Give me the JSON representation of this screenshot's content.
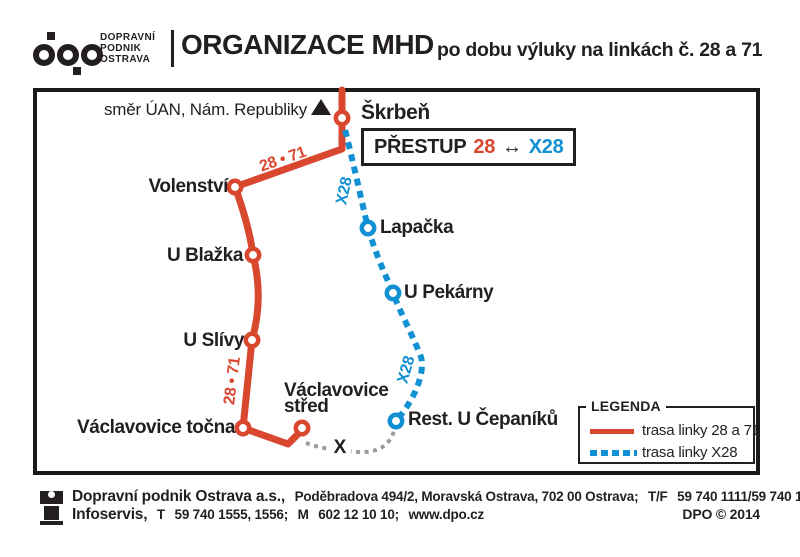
{
  "header": {
    "logo": {
      "line1": "DOPRAVNÍ",
      "line2": "PODNIK",
      "line3": "OSTRAVA"
    },
    "title": "ORGANIZACE MHD",
    "subtitle": "po dobu výluky na linkách č. 28 a 71"
  },
  "map": {
    "direction_note": "směr ÚAN, Nám. Republiky",
    "transfer": {
      "prefix": "PŘESTUP",
      "line_a": "28",
      "arrow": "↔",
      "line_b": "X28"
    },
    "route_labels": {
      "red_upper": "28 • 71",
      "red_lower": "28 • 71",
      "x28_upper": "X28",
      "x28_lower": "X28",
      "closure_mark": "X"
    },
    "stops": {
      "skrben": "Škrbeň",
      "volenstvi": "Volenství",
      "u_blazka": "U Blažka",
      "u_slivy": "U Slívy",
      "lapacka": "Lapačka",
      "u_pekarny": "U Pekárny",
      "vaclavovice_tocna": "Václavovice točna",
      "vaclavovice_stred_line1": "Václavovice",
      "vaclavovice_stred_line2": "střed",
      "rest_u_cepaniku": "Rest. U Čepaníků"
    },
    "colors": {
      "red": "#d9472f",
      "blue": "#1191d3",
      "gray": "#9b9b9b",
      "black": "#231f20"
    }
  },
  "legend": {
    "title": "LEGENDA",
    "items": [
      {
        "label": "trasa linky 28 a 71"
      },
      {
        "label": "trasa linky X28"
      }
    ]
  },
  "footer": {
    "line1_company": "Dopravní podnik Ostrava a.s.,",
    "line1_address": "Poděbradova 494/2, Moravská Ostrava, 702 00 Ostrava;",
    "line1_tf_label": "T/F",
    "line1_tf_numbers": "59 740 1111/59 740 1095;",
    "line2_name": "Infoservis,",
    "line2_t_label": "T",
    "line2_t_numbers": "59 740 1555, 1556;",
    "line2_m_label": "M",
    "line2_m_numbers": "602 12 10 10;",
    "line2_web": "www.dpo.cz",
    "copyright": "DPO © 2014"
  }
}
